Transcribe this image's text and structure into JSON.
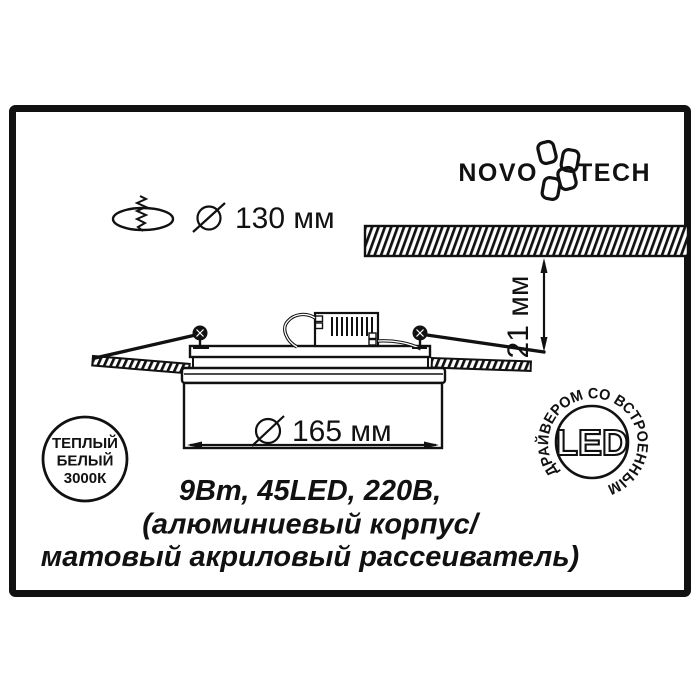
{
  "colors": {
    "ink": "#111111",
    "paper": "#ffffff"
  },
  "logo": {
    "brand": "NOVOTECH",
    "left": "NOVO",
    "right": "TECH"
  },
  "cutout": {
    "diameter_label": "130 мм"
  },
  "ceiling": {
    "depth_label": "21 мм"
  },
  "fixture": {
    "diameter_label": "165 мм"
  },
  "specs": {
    "line1": "9Вт, 45LED, 220В,",
    "line2": "(алюминиевый корпус/",
    "line3": "матовый акриловый рассеиватель)"
  },
  "badge": {
    "line1": "ТЕПЛЫЙ",
    "line2": "БЕЛЫЙ",
    "line3": "3000К"
  },
  "led_stamp": {
    "label": "LED",
    "ring_text": "ДРАЙВЕРОМ СО ВСТРОЕННЫМ"
  }
}
